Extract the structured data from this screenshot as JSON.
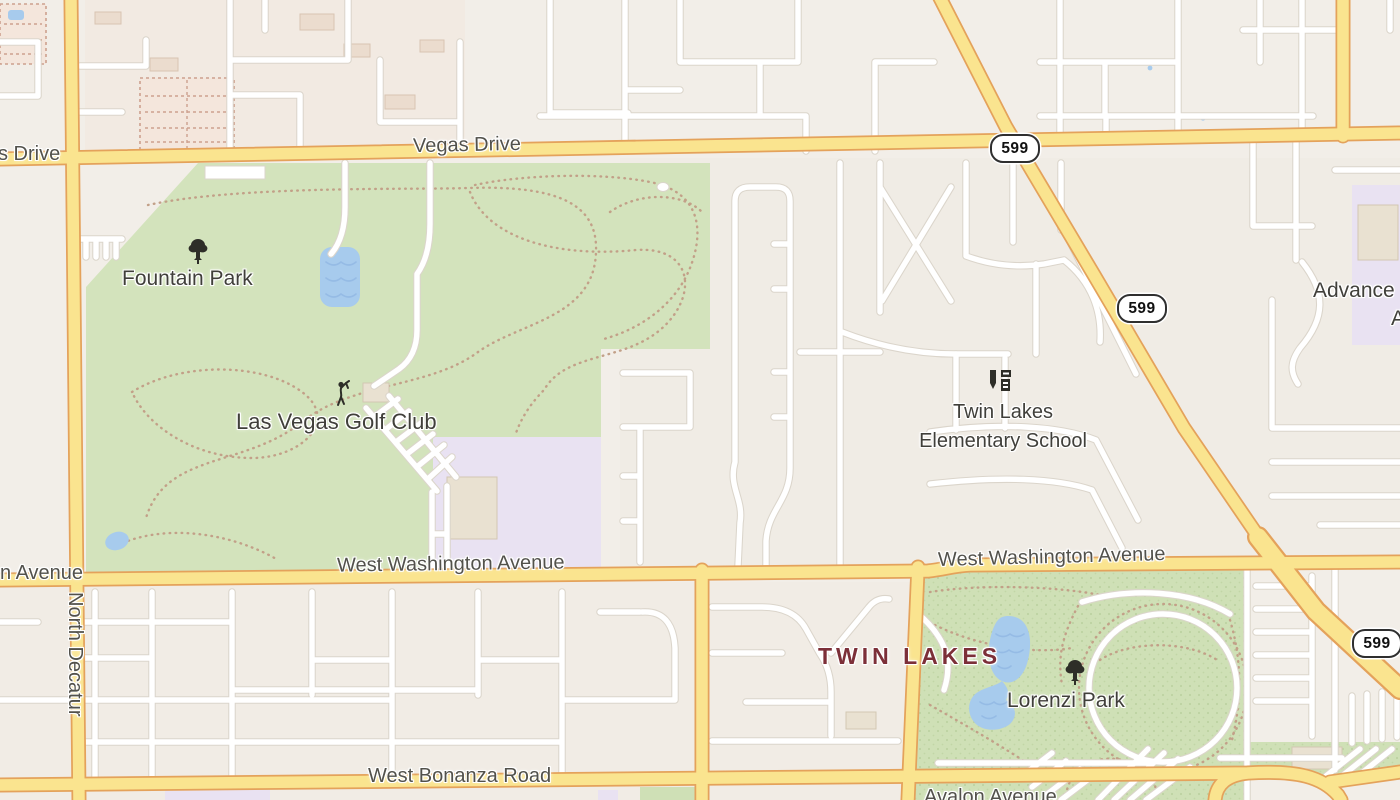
{
  "roads": {
    "vegas_drive_partial": "s Drive",
    "vegas_drive": "Vegas Drive",
    "washington_partial": "n Avenue",
    "washington_left": "West Washington Avenue",
    "washington_right": "West Washington Avenue",
    "north_decatur": "North Decatur",
    "bonanza": "West Bonanza Road",
    "avalon": "Avalon Avenue"
  },
  "route_shields": [
    {
      "label": "599"
    },
    {
      "label": "599"
    },
    {
      "label": "599"
    }
  ],
  "places": {
    "fountain_park": "Fountain Park",
    "golf_club": "Las Vegas Golf Club",
    "school_line1": "Twin Lakes",
    "school_line2": "Elementary School",
    "neighborhood": "TWIN LAKES",
    "lorenzi_park": "Lorenzi Park",
    "advance_partial_line1": "Advance",
    "advance_partial_line2": "A"
  },
  "icons": {
    "fountain_park": "tree-icon",
    "golf_club": "golfer-icon",
    "school": "school-icon",
    "lorenzi_park": "tree-icon"
  },
  "colors": {
    "road_primary_fill": "#FAE48F",
    "road_primary_casing": "#E4A25B",
    "road_minor": "#FFFFFF",
    "park_green": "#D3E3BC",
    "water_blue": "#A7CBED",
    "school_lavender": "#E9E2F2",
    "trail_brown": "#C2A088",
    "neighborhood_label": "#7C2F38",
    "label_gray": "#4C4B45",
    "shield_border": "#2F2F2F"
  }
}
